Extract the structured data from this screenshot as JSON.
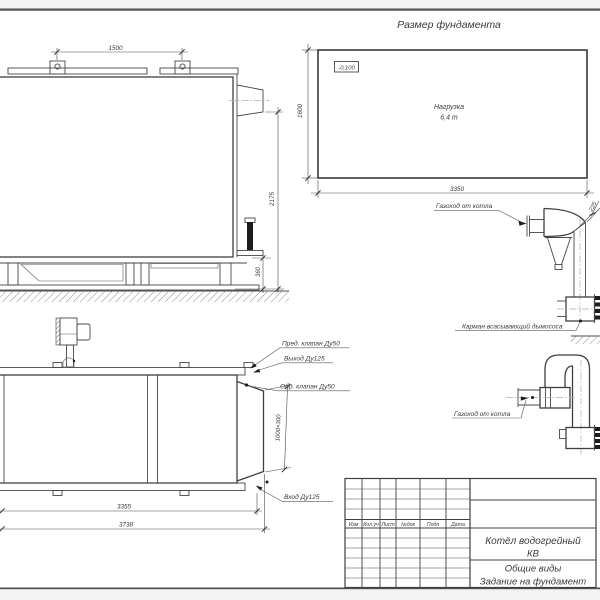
{
  "foundation": {
    "title": "Размер фундамента",
    "elevation_mark": "-0,100",
    "load_label": "Нагрузка",
    "load_value": "6,4 т",
    "dim_width": "3350",
    "dim_depth": "1600"
  },
  "side_view": {
    "dim_lug_spacing": "1500",
    "dim_height": "2175",
    "dim_base_height": "360"
  },
  "plan_view": {
    "dim_length": "3355",
    "dim_overall_length": "3738",
    "dim_outlet": "1000×300",
    "label_safety_valve": "Пред. клапан Ду50",
    "label_outlet": "Выход Ду125",
    "label_check_valve": "Обр. клапан Ду50",
    "label_inlet": "Вход Ду125"
  },
  "flue_upper": {
    "label": "Газоход от котла",
    "dim_width": "225",
    "pocket_label": "Карман всасывающий дымососа"
  },
  "flue_lower": {
    "label": "Газоход от котла"
  },
  "title_block": {
    "columns": [
      "Изм",
      "Кол.уч",
      "Лист",
      "№док",
      "Подп",
      "Дата"
    ],
    "product_line1": "Котёл водогрейный",
    "product_line2": "КВ",
    "doc_line1": "Общие виды",
    "doc_line2": "Задание на фундамент"
  }
}
